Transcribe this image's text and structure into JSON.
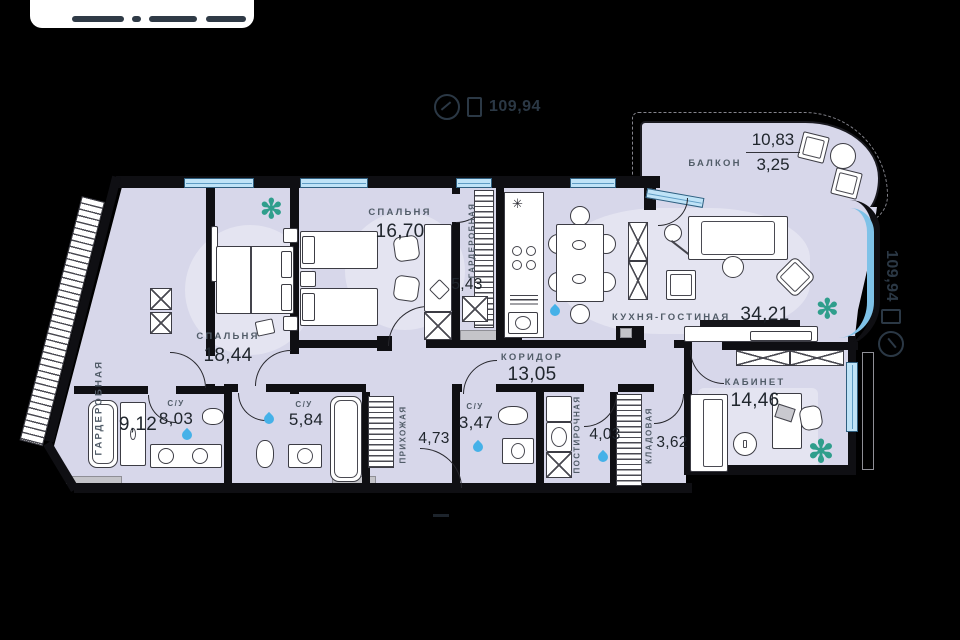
{
  "markers": {
    "top": {
      "icon": "compass-icon",
      "value": "109,94"
    },
    "side": {
      "icon": "compass-icon",
      "value": "109,94"
    }
  },
  "icons": {
    "plant": "✻",
    "kitchen_star": "✳"
  },
  "rooms": {
    "wardrobe_main": {
      "name": "ГАРДЕРОБНАЯ",
      "area": "9,12"
    },
    "bedroom_main": {
      "name": "СПАЛЬНЯ",
      "area": "18,44"
    },
    "bedroom_kids": {
      "name": "СПАЛЬНЯ",
      "area": "16,70"
    },
    "wardrobe_bedroom": {
      "name": "ГАРДЕРОБНАЯ",
      "area": "5,43"
    },
    "kitchen_living": {
      "name": "КУХНЯ-ГОСТИНАЯ",
      "area": "34,21"
    },
    "balcony": {
      "name": "БАЛКОН",
      "area_total": "10,83",
      "area_coeff": "3,25"
    },
    "corridor": {
      "name": "КОРИДОР",
      "area": "13,05"
    },
    "study": {
      "name": "КАБИНЕТ",
      "area": "14,46"
    },
    "bathroom_master": {
      "name": "С/У",
      "area": "8,03"
    },
    "bathroom_guest": {
      "name": "С/У",
      "area": "5,84"
    },
    "hallway": {
      "name": "ПРИХОЖАЯ",
      "area": "4,73"
    },
    "bathroom_small": {
      "name": "С/У",
      "area": "3,47"
    },
    "laundry": {
      "name": "ПОСТИРОЧНАЯ",
      "area": "4,03"
    },
    "storage": {
      "name": "КЛАДОВАЯ",
      "area": "3,62"
    }
  },
  "colors": {
    "room_fill": "#d7d7ea",
    "wall": "#0f0f13",
    "window_glass": "#bfe3f7",
    "window_frame": "#2f5f80",
    "water_icon": "#45b1e8",
    "plant": "#2f9e8c",
    "label_text": "#515c68",
    "number_text": "#20262d",
    "marker_text": "#2b3845"
  }
}
